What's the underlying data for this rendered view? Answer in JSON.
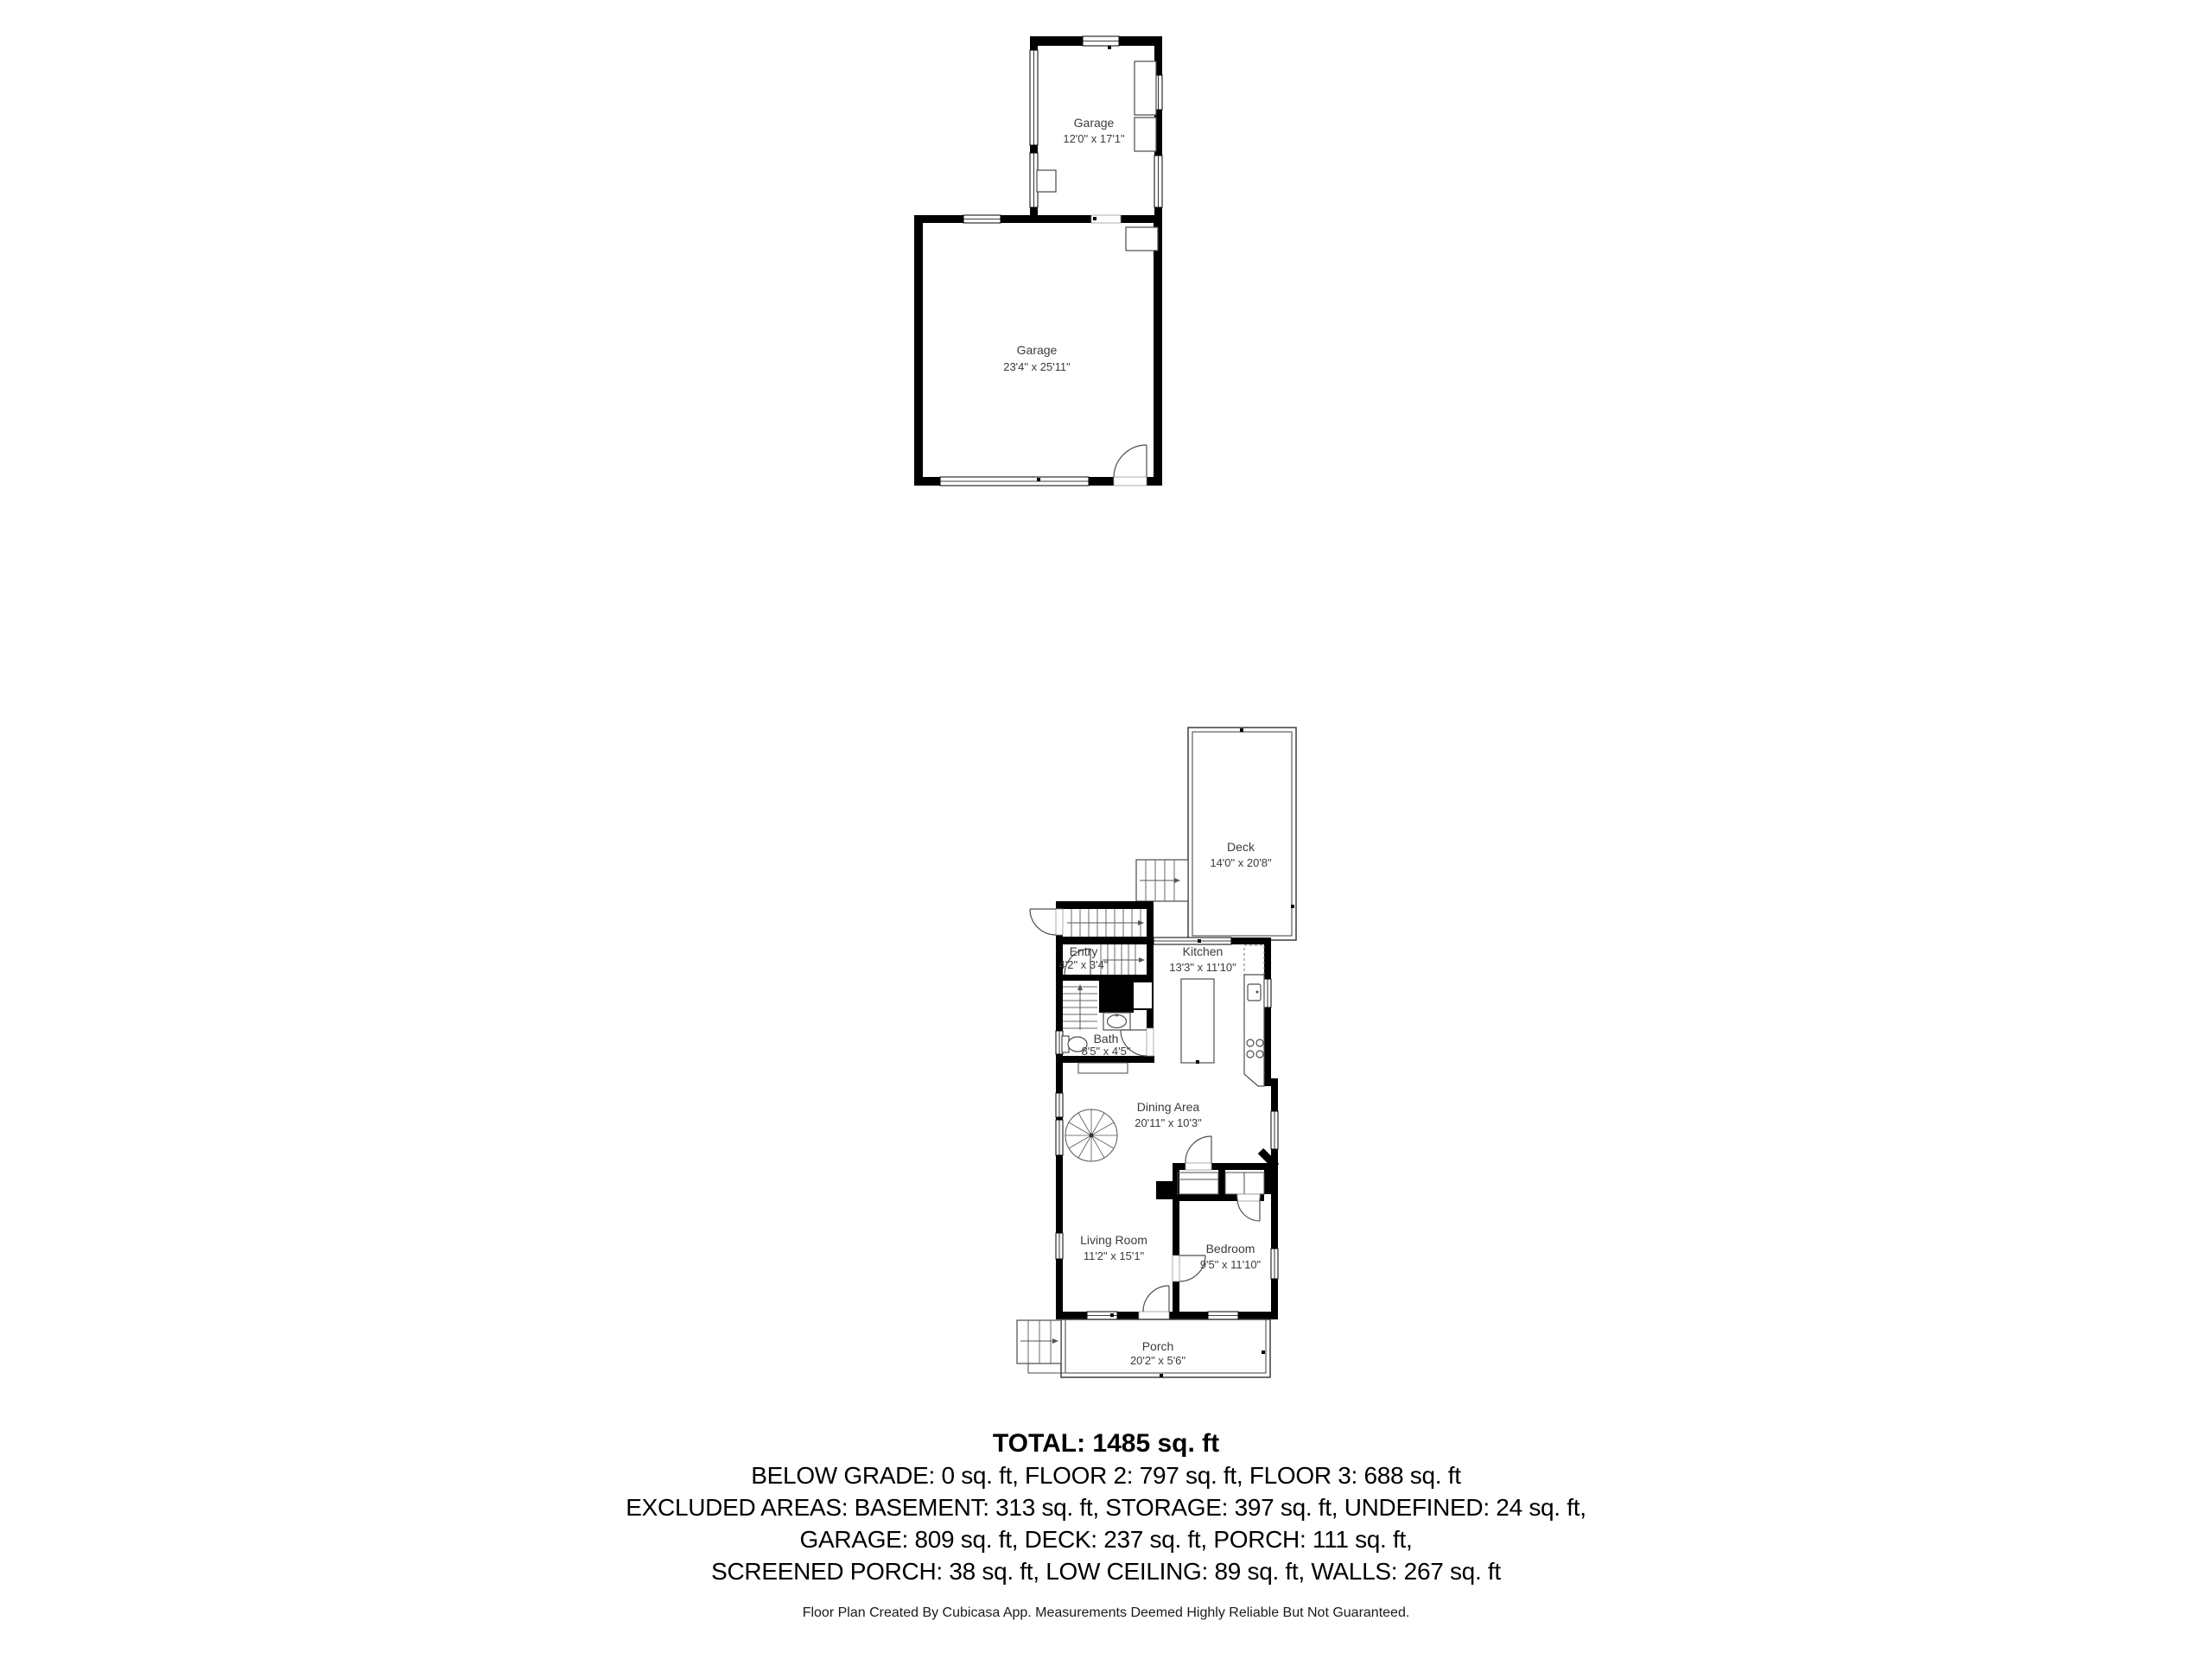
{
  "plans": {
    "garage": {
      "small": {
        "name": "Garage",
        "dims": "12'0\" x 17'1\""
      },
      "large": {
        "name": "Garage",
        "dims": "23'4\" x 25'11\""
      }
    },
    "floor": {
      "deck": {
        "name": "Deck",
        "dims": "14'0\" x 20'8\""
      },
      "entry": {
        "name": "Entry",
        "dims": "4'2\" x 3'4\""
      },
      "kitchen": {
        "name": "Kitchen",
        "dims": "13'3\" x 11'10\""
      },
      "bath": {
        "name": "Bath",
        "dims": "8'5\" x 4'5\""
      },
      "dining": {
        "name": "Dining Area",
        "dims": "20'11\" x 10'3\""
      },
      "living": {
        "name": "Living Room",
        "dims": "11'2\" x 15'1\""
      },
      "bedroom": {
        "name": "Bedroom",
        "dims": "9'5\" x 11'10\""
      },
      "porch": {
        "name": "Porch",
        "dims": "20'2\" x 5'6\""
      }
    }
  },
  "summary": {
    "total": "TOTAL: 1485 sq. ft",
    "line1": "BELOW GRADE: 0 sq. ft, FLOOR 2: 797 sq. ft, FLOOR 3: 688 sq. ft",
    "line2": "EXCLUDED AREAS: BASEMENT: 313 sq. ft, STORAGE: 397 sq. ft, UNDEFINED: 24 sq. ft,",
    "line3": "GARAGE: 809 sq. ft, DECK: 237 sq. ft, PORCH: 111 sq. ft,",
    "line4": "SCREENED PORCH: 38 sq. ft, LOW CEILING: 89 sq. ft, WALLS: 267 sq. ft",
    "footer": "Floor Plan Created By Cubicasa App. Measurements Deemed Highly Reliable But Not Guaranteed."
  },
  "colors": {
    "wall": "#000000",
    "label": "#3b3b3b",
    "line": "#4a4a4a",
    "background": "#ffffff"
  }
}
